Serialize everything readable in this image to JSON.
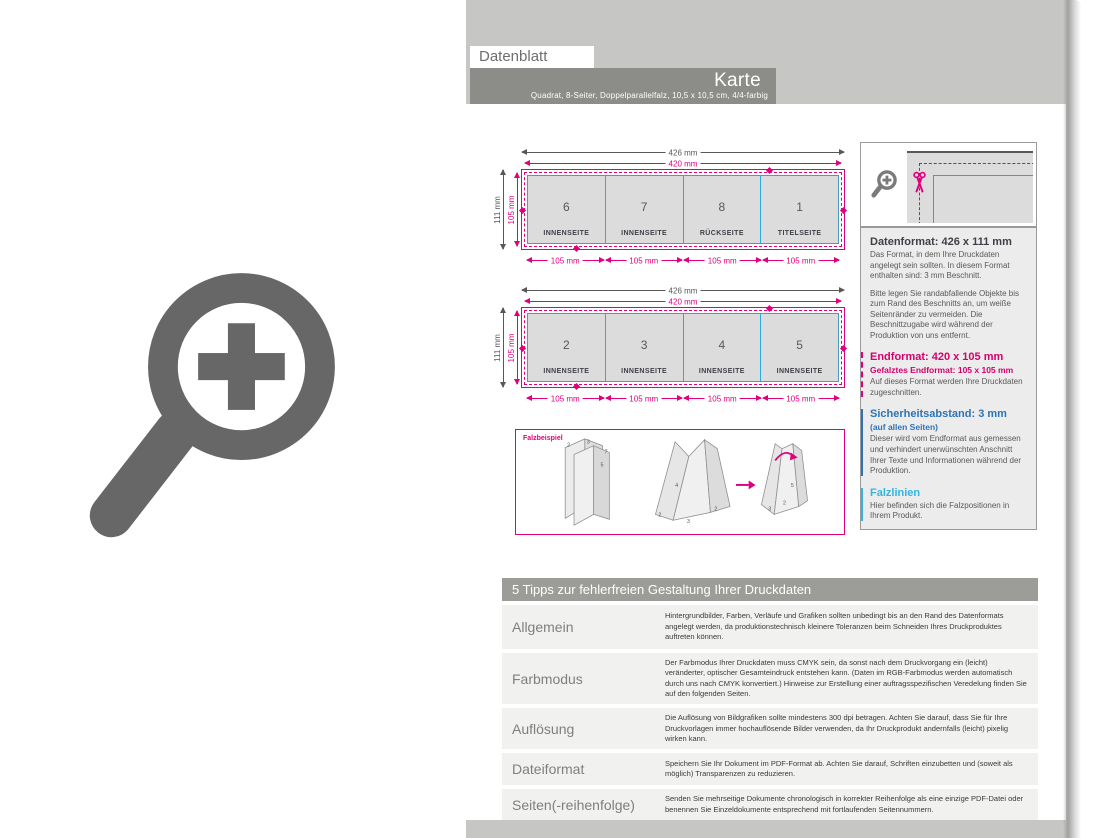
{
  "page": {
    "tab_label": "Datenblatt",
    "title": "Karte",
    "subtitle": "Quadrat, 8-Seiter, Doppelparallelfalz, 10,5 x 10,5 cm, 4/4-farbig"
  },
  "diagrams": {
    "width_outer": "426 mm",
    "width_trim": "420 mm",
    "height_outer": "111 mm",
    "height_trim": "105 mm",
    "panel_width": "105 mm",
    "sheets": [
      {
        "panels": [
          {
            "num": "6",
            "label": "INNENSEITE"
          },
          {
            "num": "7",
            "label": "INNENSEITE"
          },
          {
            "num": "8",
            "label": "RÜCKSEITE"
          },
          {
            "num": "1",
            "label": "TITELSEITE"
          }
        ]
      },
      {
        "panels": [
          {
            "num": "2",
            "label": "INNENSEITE"
          },
          {
            "num": "3",
            "label": "INNENSEITE"
          },
          {
            "num": "4",
            "label": "INNENSEITE"
          },
          {
            "num": "5",
            "label": "INNENSEITE"
          }
        ]
      }
    ]
  },
  "fold_example": {
    "label": "Falzbeispiel",
    "nums": [
      "2",
      "3",
      "7",
      "5",
      "4",
      "2",
      "3",
      "2",
      "5",
      "2",
      "3"
    ]
  },
  "info_panel": {
    "datenformat": {
      "heading": "Datenformat: 426 x 111 mm",
      "p1": "Das Format, in dem Ihre Druckdaten angelegt sein sollten. In diesem Format enthalten sind: 3 mm Beschnitt.",
      "p2": "Bitte legen Sie randabfallende Objekte bis zum Rand des Beschnitts an, um weiße Seitenränder zu vermeiden. Die Beschnittzugabe wird während der Produktion von uns entfernt."
    },
    "endformat": {
      "heading": "Endformat: 420 x 105 mm",
      "sub": "Gefalztes Endformat: 105 x 105 mm",
      "p": "Auf dieses Format werden Ihre Druckdaten zugeschnitten."
    },
    "sicherheitsabstand": {
      "heading": "Sicherheitsabstand: 3 mm",
      "sub": "(auf allen Seiten)",
      "p": "Dieser wird vom Endformat aus gemessen und verhindert unerwünschten Anschnitt Ihrer Texte und Informationen während der Produktion."
    },
    "falzlinien": {
      "heading": "Falzlinien",
      "p": "Hier befinden sich die Falzpositionen in Ihrem Produkt."
    }
  },
  "tips": {
    "header": "5 Tipps zur fehlerfreien Gestaltung Ihrer Druckdaten",
    "rows": [
      {
        "label": "Allgemein",
        "text": "Hintergrundbilder, Farben, Verläufe und Grafiken sollten unbedingt bis an den Rand des Datenformats angelegt werden, da produktionstechnisch kleinere Toleranzen beim Schneiden Ihres Druckproduktes auftreten können."
      },
      {
        "label": "Farbmodus",
        "text": "Der Farbmodus Ihrer Druckdaten muss CMYK sein, da sonst nach dem Druckvorgang ein (leicht) veränderter, optischer Gesamteindruck entstehen kann. (Daten im RGB-Farbmodus werden automatisch durch uns nach CMYK konvertiert.) Hinweise zur Erstellung einer auftragsspezifischen Veredelung finden Sie auf den folgenden Seiten."
      },
      {
        "label": "Auflösung",
        "text": "Die Auflösung von Bildgrafiken sollte mindestens 300 dpi betragen. Achten Sie darauf, dass Sie für Ihre Druckvorlagen immer hochauflösende Bilder verwenden, da Ihr Druckprodukt andernfalls (leicht) pixelig wirken kann."
      },
      {
        "label": "Dateiformat",
        "text": "Speichern Sie Ihr Dokument im PDF-Format ab. Achten Sie darauf, Schriften einzubetten und (soweit als möglich) Transparenzen zu reduzieren."
      },
      {
        "label": "Seiten(-reihenfolge)",
        "text": "Senden Sie mehrseitige Dokumente chronologisch in korrekter Reihenfolge als eine einzige PDF-Datei oder benennen Sie Einzeldokumente entsprechend mit fortlaufenden Seitennummern."
      }
    ]
  },
  "colors": {
    "accent_magenta": "#e0007d",
    "fold_line_cyan": "#29abe2",
    "safety_blue": "#2e74b5",
    "safety_line_blue": "#4a9ac4",
    "panel_gray": "#c6c6c5",
    "title_bar_gray": "#8c8c88",
    "tips_header_gray": "#9c9c98"
  }
}
